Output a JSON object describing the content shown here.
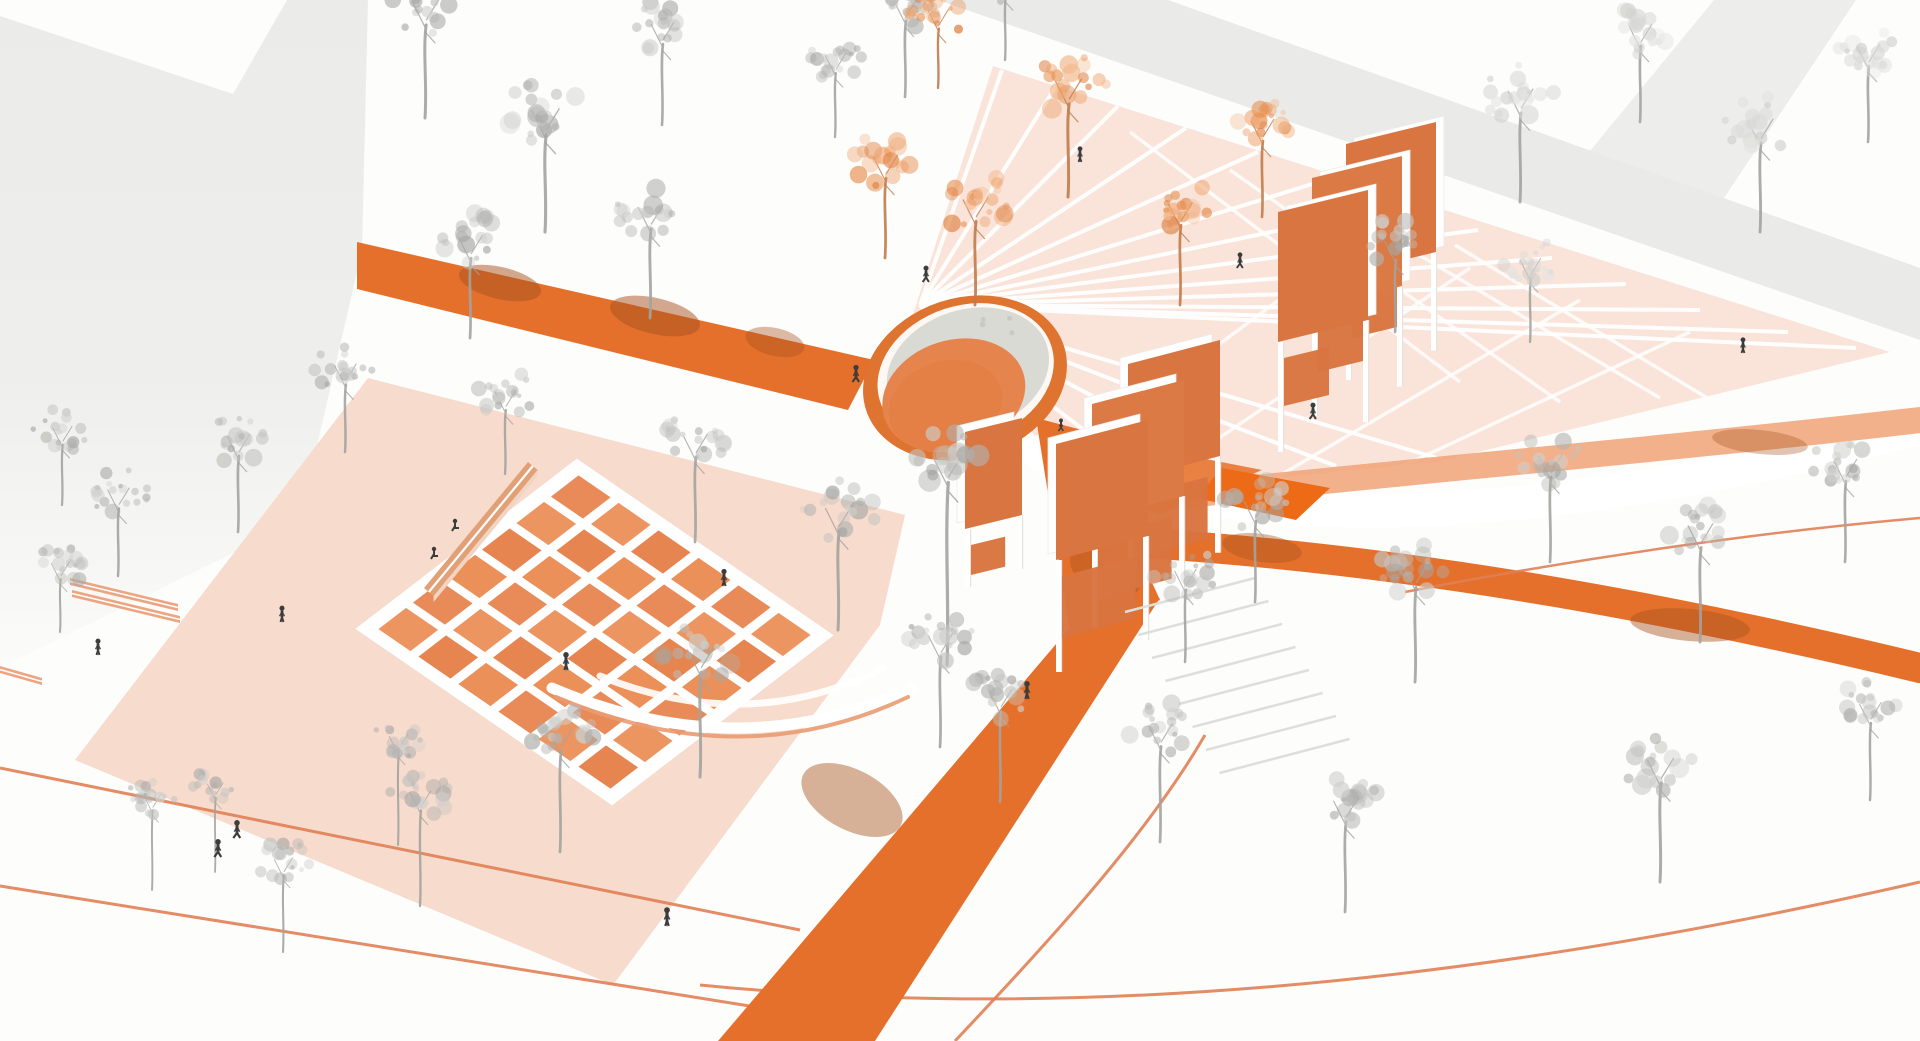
{
  "meta": {
    "title": "Axonometric landscape-architecture rendering of a public plaza in white, gray and orange",
    "canvas": {
      "w": 1920,
      "h": 1041
    }
  },
  "palette": {
    "bg": "#FDFDFC",
    "building": "#EBEBE9",
    "building_fade": "#FBFBF9",
    "building_band": "#E8E8E6",
    "plaza_left": "#F7DBCD",
    "plaza_radiating": "#FAE4D9",
    "white_line": "#FFFFFF",
    "road_orange": "#E5702B",
    "band_salmon": "#F0A377",
    "band_dark": "#E4702B",
    "quad_dark": "#ED6A16",
    "wedge": "#E87B3A",
    "thin_line": "#E08055",
    "panel": "#DB7A44",
    "panel_alt": "#D97540",
    "tile_fills": [
      "#E98B58",
      "#EB9059",
      "#E6854F",
      "#ED9560"
    ],
    "bench": "#E2A077",
    "bench_side": "#F1D4C2",
    "bench_slat": "#EDA480",
    "dome_ring": "#DF7330",
    "dome_rim": "#FFFFFF",
    "dome_shell": "#DADAD5",
    "dome_egg": "#E6844D",
    "dome_egg2": "#E27A40",
    "shadow_patch": "#A8521F",
    "step_line": "#DEDEDB",
    "leg_edge": "#E6E3DF",
    "tree_gray": [
      "#C2C2BF",
      "#B3B3B0",
      "#A7A7A4",
      "#CFCFCC"
    ],
    "tree_faint": [
      "#D9D9D6",
      "#E3E3E0",
      "#CFCFCC"
    ],
    "tree_orange": [
      "#EFA671",
      "#E78F4F",
      "#DD7B39",
      "#F2BA90"
    ],
    "trunk_gray": "#A3A3A0",
    "trunk_orange": "#C07B4A",
    "person": "#3C3C3C"
  },
  "scene": {
    "buildings": {
      "left_mass": [
        [
          0,
          16
        ],
        [
          233,
          94
        ],
        [
          287,
          0
        ],
        [
          368,
          0
        ],
        [
          362,
          250
        ],
        [
          300,
          520
        ],
        [
          0,
          668
        ]
      ],
      "top_band": [
        [
          938,
          0
        ],
        [
          1168,
          0
        ],
        [
          1920,
          268
        ],
        [
          1920,
          340
        ]
      ],
      "top_band_fork": [
        [
          1553,
          196
        ],
        [
          1714,
          0
        ],
        [
          1856,
          0
        ],
        [
          1688,
          252
        ]
      ]
    },
    "plazas": {
      "left": [
        [
          368,
          378
        ],
        [
          905,
          515
        ],
        [
          880,
          625
        ],
        [
          613,
          985
        ],
        [
          75,
          760
        ]
      ],
      "radiating": [
        [
          908,
          330
        ],
        [
          993,
          66
        ],
        [
          1890,
          352
        ],
        [
          1437,
          462
        ],
        [
          1270,
          478
        ],
        [
          1150,
          487
        ],
        [
          1048,
          446
        ]
      ]
    },
    "radial": {
      "center": [
        920,
        305
      ],
      "ends": [
        [
          1002,
          70
        ],
        [
          1056,
          86
        ],
        [
          1118,
          106
        ],
        [
          1186,
          128
        ],
        [
          1258,
          152
        ],
        [
          1332,
          178
        ],
        [
          1406,
          204
        ],
        [
          1478,
          230
        ],
        [
          1552,
          258
        ],
        [
          1626,
          284
        ],
        [
          1700,
          310
        ],
        [
          1788,
          332
        ],
        [
          1856,
          348
        ],
        [
          1437,
          458
        ],
        [
          1336,
          466
        ],
        [
          1240,
          474
        ],
        [
          1152,
          482
        ],
        [
          1072,
          462
        ],
        [
          1012,
          420
        ]
      ],
      "cross": [
        [
          1060,
          462,
          1360,
          240
        ],
        [
          1160,
          478,
          1470,
          268
        ],
        [
          1272,
          480,
          1580,
          300
        ],
        [
          1390,
          472,
          1690,
          332
        ],
        [
          1230,
          170,
          1560,
          402
        ],
        [
          1340,
          208,
          1660,
          398
        ],
        [
          1130,
          132,
          1460,
          382
        ],
        [
          1455,
          245,
          1760,
          430
        ]
      ]
    },
    "roads": {
      "upper_band": [
        [
          357,
          242
        ],
        [
          874,
          360
        ],
        [
          848,
          410
        ],
        [
          357,
          289
        ]
      ],
      "dome_exit": [
        [
          1036,
          418
        ],
        [
          1082,
          430
        ],
        [
          1160,
          600
        ],
        [
          1070,
          632
        ]
      ],
      "main_diagonal": [
        [
          1068,
          630
        ],
        [
          1160,
          598
        ],
        [
          875,
          1041
        ],
        [
          718,
          1041
        ]
      ]
    },
    "strokes": {
      "white_cut": {
        "d": "M1038,452 C1260,545 1560,520 1920,428",
        "w": 34,
        "c": "#FFFFFF",
        "o": 1
      },
      "salmon_band": {
        "d": "M1140,500 C1420,470 1680,448 1920,420",
        "w": 26,
        "c": "#F0A377",
        "o": 0.85
      },
      "dark_band": {
        "d": "M1128,542 C1430,560 1700,615 1920,668",
        "w": 30,
        "c": "#E4702B",
        "o": 1
      }
    },
    "quads": {
      "dark_quad": [
        [
          1222,
          468
        ],
        [
          1330,
          488
        ],
        [
          1296,
          520
        ],
        [
          1196,
          498
        ]
      ],
      "wedge": [
        [
          1058,
          478
        ],
        [
          1150,
          448
        ],
        [
          1262,
          470
        ],
        [
          1160,
          515
        ]
      ]
    },
    "thin_lines": [
      {
        "d": "M0,768 L800,930",
        "w": 3
      },
      {
        "d": "M0,886 L762,1008",
        "w": 3
      },
      {
        "d": "M1205,735 C1150,830 1060,930 955,1041",
        "w": 3
      },
      {
        "d": "M700,985 C1050,1020 1450,990 1920,882",
        "w": 3
      },
      {
        "d": "M1405,592 C1580,558 1760,532 1920,518",
        "w": 2.5
      }
    ],
    "grid": {
      "t": [
        578,
        470
      ],
      "u": [
        40,
        27.5
      ],
      "v": [
        -34.5,
        26.5
      ],
      "n": 6,
      "inset": 0.1
    },
    "arcs": [
      {
        "d": "M552,688 Q740,768 912,688",
        "w": 11,
        "c": "#FFFFFF",
        "o": 1
      },
      {
        "d": "M556,697 Q742,776 908,697",
        "w": 4,
        "c": "#E99B72",
        "o": 0.9
      },
      {
        "d": "M600,676 Q748,736 884,668",
        "w": 7,
        "c": "#FFFFFF",
        "o": 0.9
      }
    ],
    "benches": {
      "long": {
        "top": [
          [
            424,
            588
          ],
          [
            528,
            462
          ],
          [
            537.6,
            469.9
          ],
          [
            433.6,
            595.9
          ]
        ],
        "side": [
          [
            433.6,
            595.9
          ],
          [
            537.6,
            469.9
          ],
          [
            537.6,
            476
          ],
          [
            433.6,
            602
          ]
        ],
        "stripe": "M428.8,592 L532.8,466"
      },
      "slats": [
        [
          [
            70,
            578
          ],
          [
            178,
            604
          ],
          [
            178,
            611
          ],
          [
            70,
            585
          ]
        ],
        [
          [
            72,
            590
          ],
          [
            180,
            616
          ],
          [
            180,
            623
          ],
          [
            72,
            597
          ]
        ],
        [
          [
            0,
            666
          ],
          [
            42,
            678
          ],
          [
            42,
            685
          ],
          [
            0,
            673
          ]
        ]
      ]
    },
    "dome": {
      "cx": 965,
      "cy": 378,
      "rot": -18,
      "ring": {
        "rx": 104,
        "ry": 80,
        "c": "#DF7330"
      },
      "rim": {
        "cx": 967,
        "cy": 374,
        "rx": 90,
        "ry": 68,
        "c": "#FFFFFF"
      },
      "shell": {
        "cx": 970,
        "cy": 372,
        "rx": 83,
        "ry": 61,
        "c": "#DADAD5"
      },
      "egg": {
        "cx": 949,
        "cy": 391,
        "rx": 73,
        "ry": 55,
        "c": "#E6844D"
      },
      "egg2": {
        "cx": 938,
        "cy": 398,
        "rx": 58,
        "ry": 44,
        "c": "#E27A40",
        "o": 0.5
      }
    },
    "gates": {
      "upper": {
        "xs": [
          1278,
          1312,
          1346
        ],
        "ys": [
          212,
          178,
          144
        ],
        "w": 90,
        "h": 130,
        "skew": 22,
        "legs": [
          110,
          108,
          106
        ],
        "frame": "right",
        "sub_w": 0.5,
        "sub_h": 48
      },
      "center": {
        "xs": [
          1056,
          1092,
          1128
        ],
        "ys": [
          444,
          404,
          364
        ],
        "w": 92,
        "h": 116,
        "skew": 24,
        "legs": [
          112,
          108,
          104
        ],
        "frame": "left",
        "sub_w": 0.8,
        "sub_h": 62
      },
      "small": {
        "xs": [
          965
        ],
        "ys": [
          432
        ],
        "w": 57,
        "h": 97,
        "skew": 14,
        "legs": [
          58
        ],
        "frame": "left",
        "sub_w": 0.6,
        "sub_h": 30
      }
    },
    "stairs": {
      "x0": 1125,
      "y0": 612,
      "dx": 13.5,
      "dy": 23,
      "len": 130,
      "drop": -34,
      "count": 8
    },
    "shadow_patches": [
      [
        500,
        283,
        42,
        16,
        13,
        0.5
      ],
      [
        655,
        316,
        46,
        18,
        13,
        0.5
      ],
      [
        775,
        342,
        30,
        14,
        13,
        0.4
      ],
      [
        852,
        800,
        30,
        55,
        -62,
        0.45
      ],
      [
        1105,
        572,
        22,
        38,
        -62,
        0.4
      ],
      [
        1690,
        625,
        60,
        16,
        5,
        0.45
      ],
      [
        1262,
        548,
        40,
        14,
        8,
        0.4
      ],
      [
        1760,
        442,
        48,
        12,
        6,
        0.35
      ]
    ],
    "trees": [
      [
        425,
        118,
        1.15,
        0,
        95
      ],
      [
        545,
        232,
        1.2,
        0,
        95
      ],
      [
        662,
        125,
        1.0,
        0,
        95
      ],
      [
        470,
        338,
        1.05,
        0,
        90
      ],
      [
        650,
        318,
        1.1,
        0,
        95
      ],
      [
        947,
        665,
        1.25,
        0,
        160
      ],
      [
        345,
        452,
        0.95,
        0,
        85
      ],
      [
        238,
        532,
        1.0,
        0,
        90
      ],
      [
        118,
        576,
        0.95,
        0,
        85
      ],
      [
        60,
        632,
        0.8,
        0,
        80
      ],
      [
        505,
        474,
        0.9,
        0,
        85
      ],
      [
        695,
        542,
        1.05,
        0,
        95
      ],
      [
        838,
        630,
        1.15,
        0,
        100
      ],
      [
        700,
        777,
        1.15,
        0,
        105
      ],
      [
        560,
        852,
        1.05,
        0,
        110
      ],
      [
        420,
        906,
        0.9,
        0,
        120
      ],
      [
        283,
        952,
        0.8,
        0,
        110
      ],
      [
        152,
        890,
        0.75,
        0,
        120
      ],
      [
        215,
        872,
        0.7,
        0,
        120
      ],
      [
        398,
        845,
        0.8,
        0,
        130
      ],
      [
        940,
        747,
        1.05,
        0,
        100
      ],
      [
        1000,
        802,
        1.0,
        0,
        105
      ],
      [
        1160,
        842,
        1.05,
        0,
        105
      ],
      [
        1345,
        912,
        1.05,
        0,
        100
      ],
      [
        1660,
        882,
        1.15,
        0,
        100
      ],
      [
        1870,
        800,
        0.95,
        0,
        95
      ],
      [
        1255,
        602,
        1.0,
        0,
        95
      ],
      [
        1415,
        682,
        1.1,
        0,
        100
      ],
      [
        1550,
        562,
        1.05,
        0,
        95
      ],
      [
        1700,
        642,
        1.1,
        0,
        100
      ],
      [
        1845,
        562,
        1.0,
        0,
        95
      ],
      [
        1520,
        202,
        1.1,
        2,
        95
      ],
      [
        1640,
        122,
        1.0,
        2,
        90
      ],
      [
        1760,
        232,
        1.1,
        2,
        95
      ],
      [
        1868,
        142,
        1.0,
        2,
        90
      ],
      [
        905,
        97,
        1.0,
        0,
        90
      ],
      [
        835,
        137,
        0.9,
        0,
        85
      ],
      [
        1005,
        60,
        0.9,
        0,
        85
      ],
      [
        1395,
        332,
        0.95,
        0,
        90
      ],
      [
        1185,
        662,
        0.95,
        0,
        90
      ],
      [
        1530,
        342,
        0.9,
        2,
        85
      ],
      [
        62,
        505,
        0.85,
        0,
        85
      ],
      [
        885,
        258,
        1.05,
        1,
        90
      ],
      [
        975,
        305,
        1.1,
        1,
        90
      ],
      [
        1068,
        197,
        1.15,
        1,
        95
      ],
      [
        1180,
        305,
        1.05,
        1,
        90
      ],
      [
        1262,
        217,
        1.0,
        1,
        90
      ],
      [
        938,
        88,
        0.9,
        1,
        80
      ]
    ],
    "people": [
      [
        98,
        655,
        "stand",
        1.05
      ],
      [
        282,
        622,
        "stand",
        1.05
      ],
      [
        218,
        857,
        "walk",
        1.15
      ],
      [
        237,
        838,
        "walk",
        1.15
      ],
      [
        667,
        926,
        "stand",
        1.2
      ],
      [
        566,
        670,
        "stand",
        1.15
      ],
      [
        724,
        586,
        "stand",
        1.1
      ],
      [
        856,
        382,
        "walk",
        1.1
      ],
      [
        926,
        282,
        "walk",
        1.05
      ],
      [
        1080,
        162,
        "stand",
        1.0
      ],
      [
        1240,
        268,
        "walk",
        1.0
      ],
      [
        1313,
        419,
        "walk",
        1.05
      ],
      [
        1027,
        699,
        "stand",
        1.15
      ],
      [
        1743,
        353,
        "stand",
        1.0
      ],
      [
        1061,
        431,
        "walk",
        0.8
      ],
      [
        455,
        529,
        "sit",
        1.0
      ],
      [
        434,
        557,
        "sit",
        1.0
      ]
    ]
  }
}
